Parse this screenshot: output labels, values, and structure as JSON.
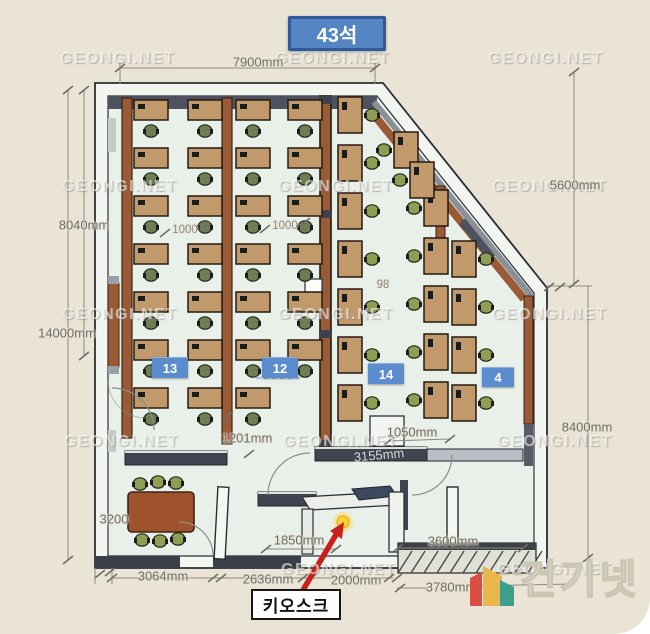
{
  "title": {
    "label": "43석"
  },
  "watermark": {
    "text": "GEONGI.NET"
  },
  "dimensions": {
    "top": "7900mm",
    "left_upper": "8040mm",
    "left_lower": "14000mm",
    "right_upper": "5600mm",
    "right_lower": "8400mm",
    "inner_left_spacing": "1000",
    "inner_right_spacing": "1000",
    "inner_small": "98",
    "lobby_left": "1201mm",
    "lobby_right": "1050mm",
    "counter": "3155mm",
    "meeting_width": "3200",
    "kiosk_width": "1850mm",
    "entrance_right": "3600mm",
    "bottom_1": "3064mm",
    "bottom_2": "2636mm",
    "bottom_3": "2000mm",
    "bottom_4": "3780mm"
  },
  "badges": [
    {
      "label": "13"
    },
    {
      "label": "12"
    },
    {
      "label": "14"
    },
    {
      "label": "4"
    }
  ],
  "annotation": {
    "kiosk_label": "키오스크"
  },
  "logo": {
    "text": "건기넷"
  },
  "colors": {
    "background": "#e9e4d6",
    "floor": "#e9f0ea",
    "wall_dark": "#3c414c",
    "wall_light": "#f2f5f0",
    "partition_brown": "#9a5a35",
    "desk_tan": "#c2996a",
    "chair_green": "#8f9e52",
    "chair_dark": "#6f7d54",
    "table_brown": "#a0522d",
    "badge_blue": "#5b8ccd",
    "title_blue": "#5585c2",
    "title_border": "#2f5a9b",
    "dimension_text": "#6f6e66",
    "arrow_red": "#c9201a",
    "highlight_yellow": "#ffd23e",
    "logo_red": "#d94f43",
    "logo_yellow": "#e8b64a",
    "logo_teal": "#3e9e8c"
  }
}
